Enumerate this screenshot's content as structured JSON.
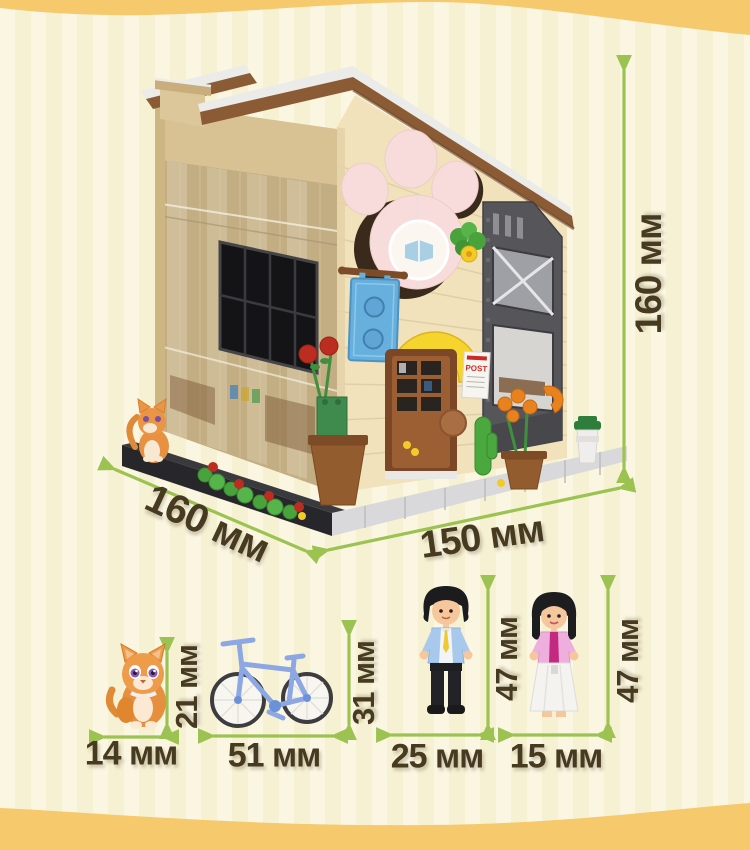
{
  "annotations": {
    "building_height": "160 мм",
    "building_depth": "160 мм",
    "building_width": "150 мм",
    "cat_width": "14 мм",
    "cat_height": "21 мм",
    "bicycle_width": "51 мм",
    "bicycle_height": "31 мм",
    "man_width": "25 мм",
    "man_height": "47 мм",
    "woman_width": "15 мм",
    "woman_height": "47 мм"
  },
  "building": {
    "post_sign_text": "POST"
  },
  "colors": {
    "background": "#f6f1d3",
    "stripe": "#faf6e2",
    "wave_band": "#f5c96c",
    "arrow": "#9cc352",
    "label_text": "#463a21"
  }
}
